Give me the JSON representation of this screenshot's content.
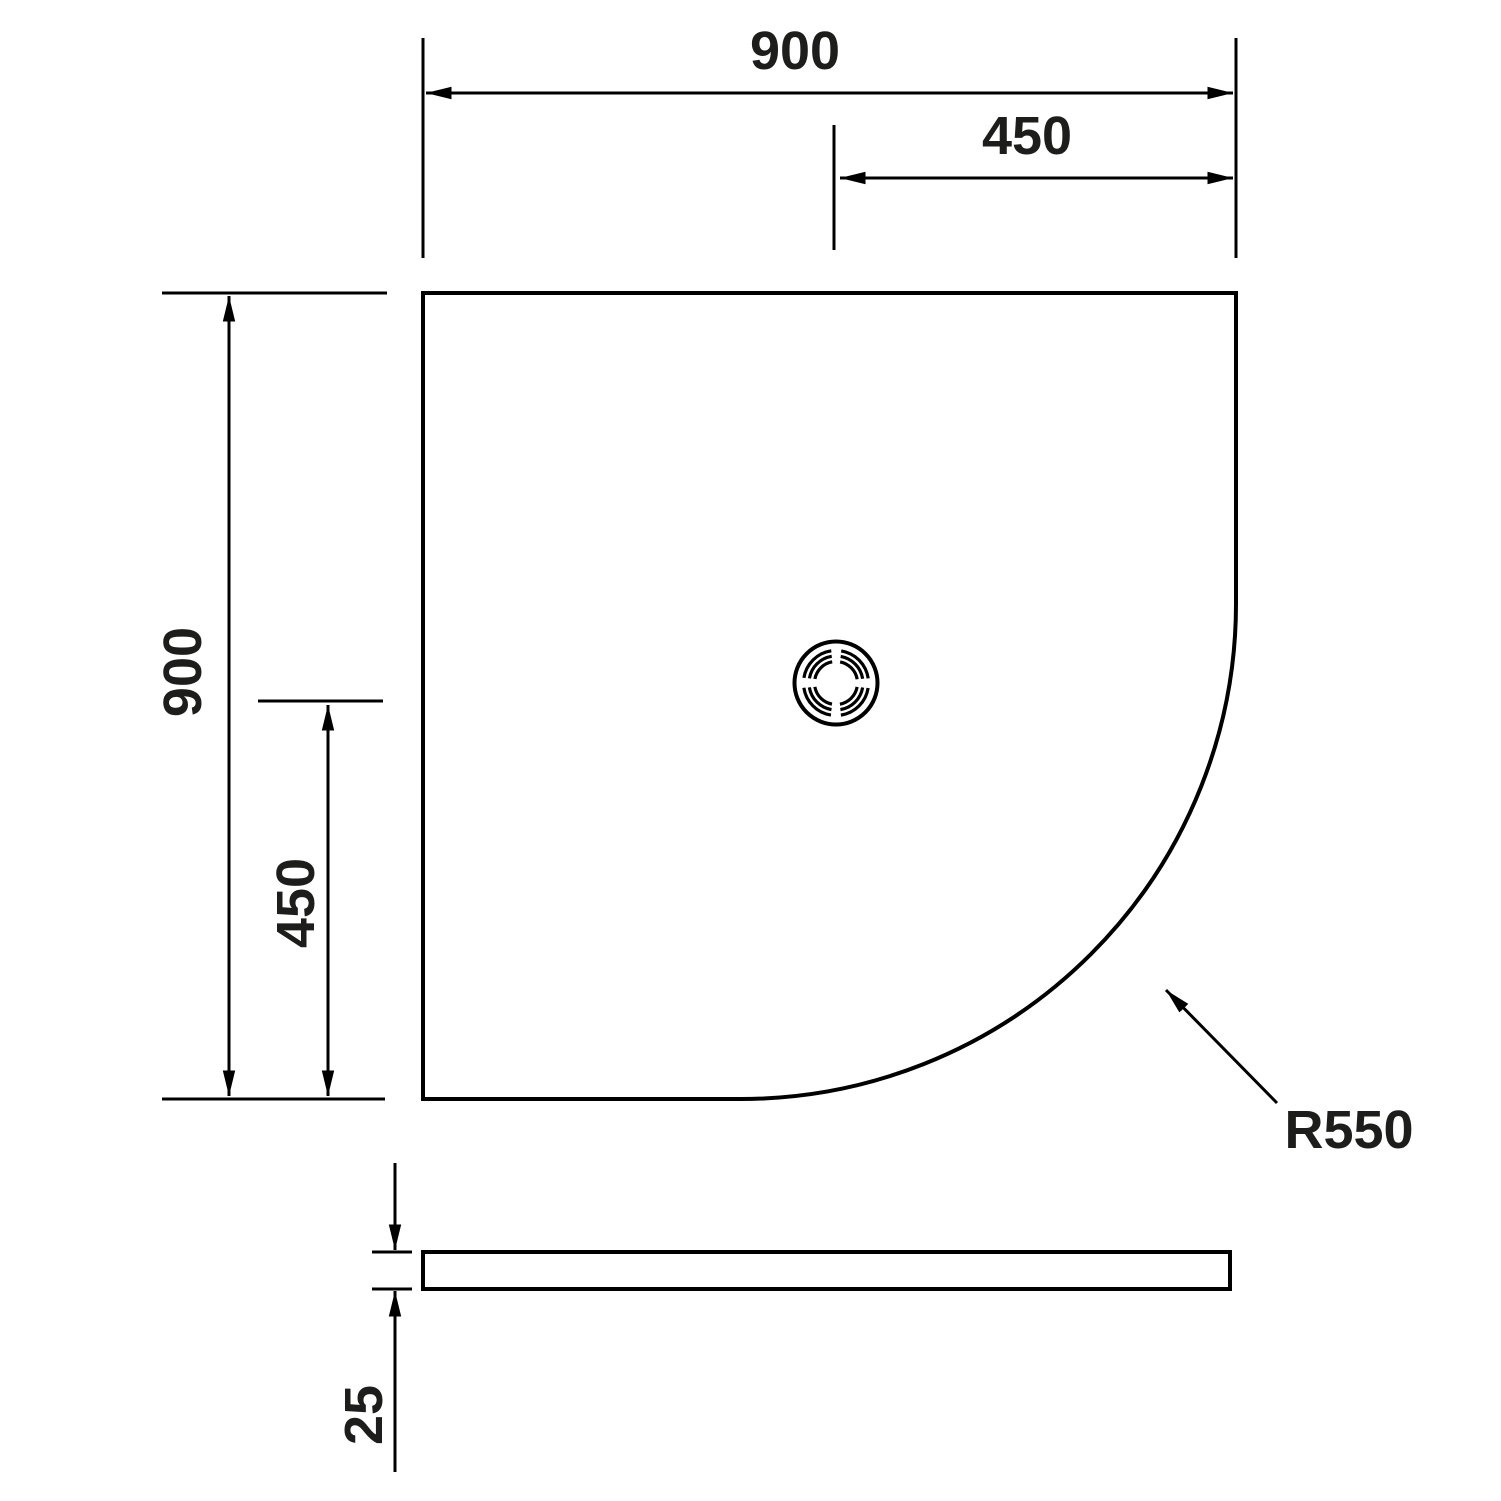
{
  "drawing": {
    "subject": "quadrant-shower-tray-dimension-drawing",
    "background_color": "#ffffff",
    "line_color": "#000000",
    "text_color": "#1d1d1b",
    "labels": {
      "top_width": "900",
      "top_half_width": "450",
      "left_height": "900",
      "left_half_height": "450",
      "corner_radius": "R550",
      "thickness": "25"
    }
  }
}
